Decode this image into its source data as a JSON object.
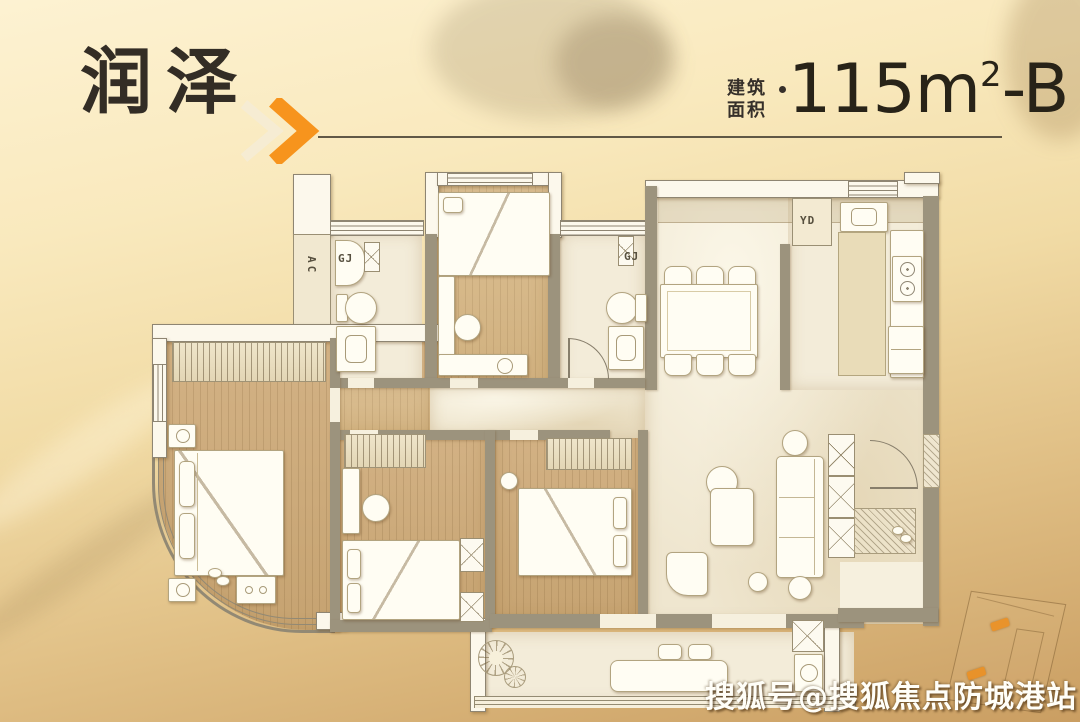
{
  "header": {
    "title": "润泽",
    "area_label_line1": "建筑",
    "area_label_line2": "面积",
    "area": {
      "value": "115",
      "unit": "m",
      "exponent": "2",
      "suffix": "-B"
    }
  },
  "plan": {
    "labels": {
      "ac": "AC",
      "gj_bath1": "GJ",
      "gj_bath2": "GJ",
      "yd": "YD"
    }
  },
  "watermark": {
    "text": "搜狐号@搜狐焦点防城港站"
  },
  "colors": {
    "accent_orange": "#f7941d",
    "header_text": "#332d25",
    "rule_line": "#453e31",
    "wall_taupe": "#9c937d",
    "wall_white": "#fcf8ec",
    "floor_wood": "#cdac7b",
    "floor_marble": "#efe6cf",
    "watermark_white": "#fffef8"
  }
}
